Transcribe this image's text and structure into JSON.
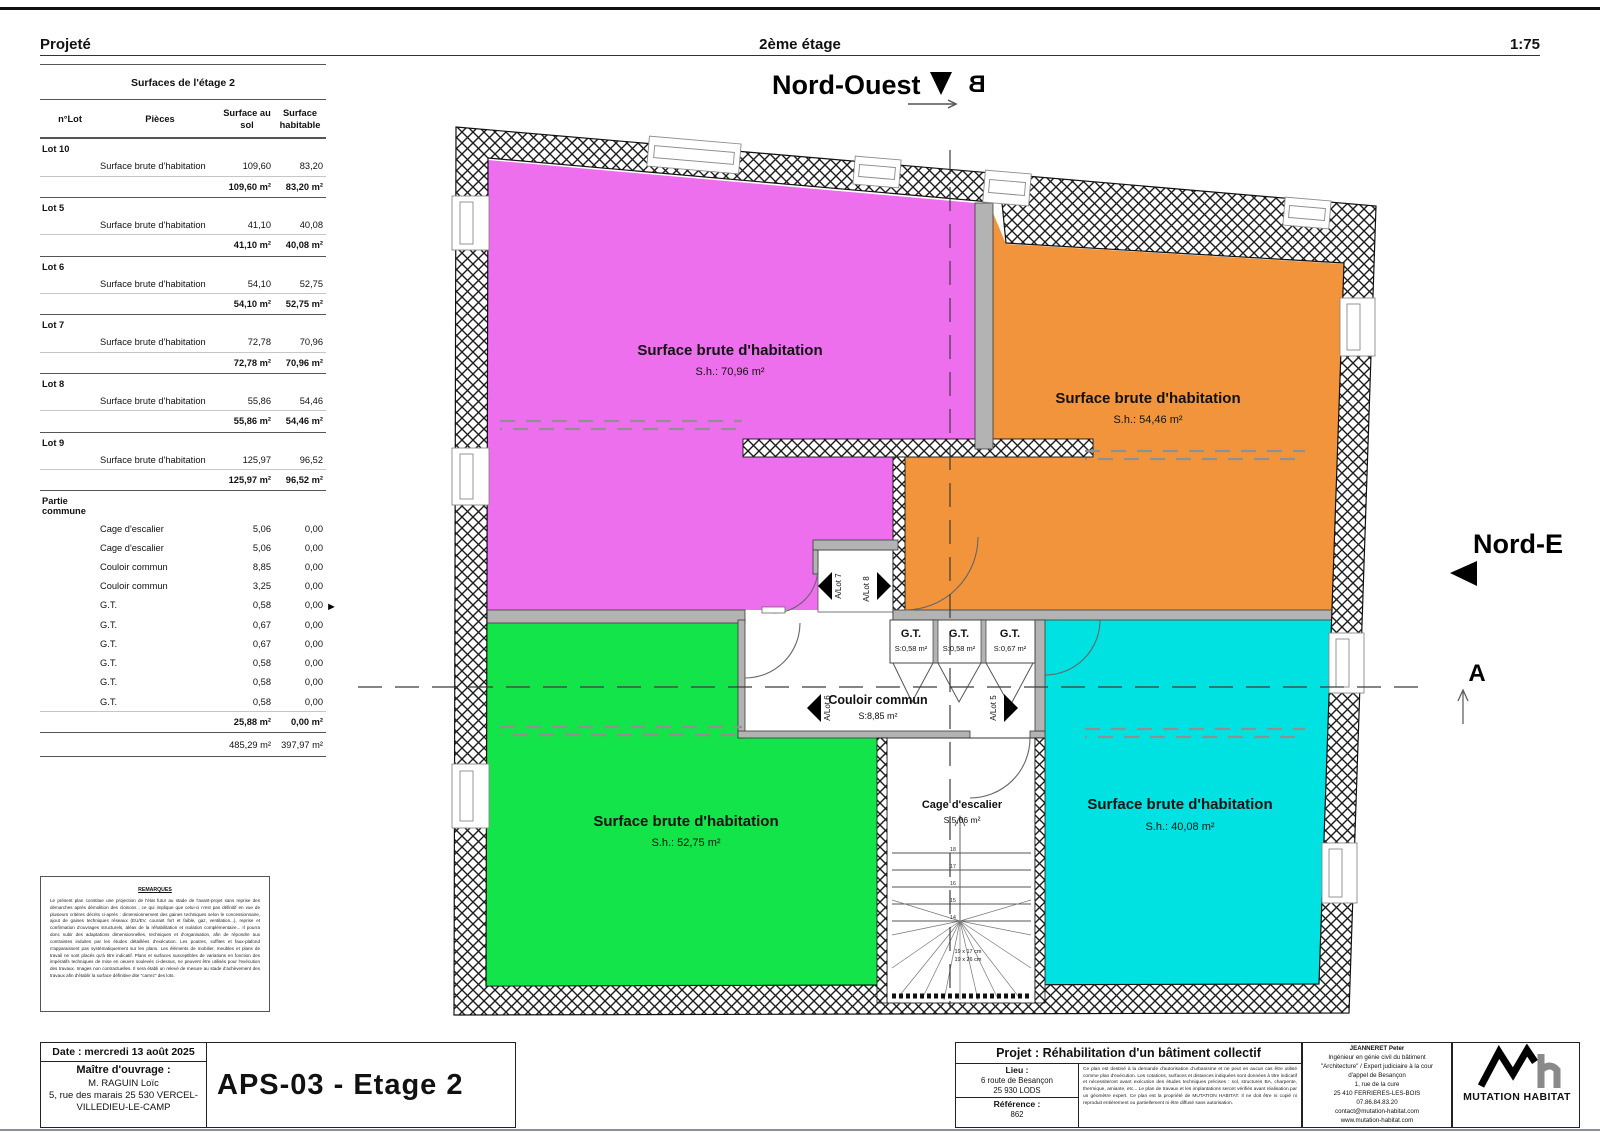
{
  "header": {
    "left": "Projeté",
    "center": "2ème étage",
    "right": "1:75"
  },
  "compass": {
    "nw": "Nord-Ouest",
    "ne": "Nord-E",
    "section_b": "B",
    "section_a": "A"
  },
  "table": {
    "title": "Surfaces de l'étage 2",
    "headers": {
      "lot": "n°Lot",
      "pieces": "Pièces",
      "sol": "Surface au sol",
      "hab": "Surface habitable"
    },
    "rows": [
      {
        "cls": "srow lot",
        "c1": "Lot 10"
      },
      {
        "cls": "srow detail",
        "c2": "Surface brute d'habitation",
        "c3": "109,60",
        "c4": "83,20"
      },
      {
        "cls": "srow total",
        "c3": "109,60 m²",
        "c4": "83,20 m²"
      },
      {
        "cls": "srow lot",
        "c1": "Lot 5"
      },
      {
        "cls": "srow detail",
        "c2": "Surface brute d'habitation",
        "c3": "41,10",
        "c4": "40,08"
      },
      {
        "cls": "srow total",
        "c3": "41,10 m²",
        "c4": "40,08 m²"
      },
      {
        "cls": "srow lot",
        "c1": "Lot 6"
      },
      {
        "cls": "srow detail",
        "c2": "Surface brute d'habitation",
        "c3": "54,10",
        "c4": "52,75"
      },
      {
        "cls": "srow total",
        "c3": "54,10 m²",
        "c4": "52,75 m²"
      },
      {
        "cls": "srow lot",
        "c1": "Lot 7"
      },
      {
        "cls": "srow detail",
        "c2": "Surface brute d'habitation",
        "c3": "72,78",
        "c4": "70,96"
      },
      {
        "cls": "srow total",
        "c3": "72,78 m²",
        "c4": "70,96 m²"
      },
      {
        "cls": "srow lot",
        "c1": "Lot 8"
      },
      {
        "cls": "srow detail",
        "c2": "Surface brute d'habitation",
        "c3": "55,86",
        "c4": "54,46"
      },
      {
        "cls": "srow total",
        "c3": "55,86 m²",
        "c4": "54,46 m²"
      },
      {
        "cls": "srow lot",
        "c1": "Lot 9"
      },
      {
        "cls": "srow detail",
        "c2": "Surface brute d'habitation",
        "c3": "125,97",
        "c4": "96,52"
      },
      {
        "cls": "srow total",
        "c3": "125,97 m²",
        "c4": "96,52 m²"
      },
      {
        "cls": "srow lot",
        "c1": "Partie commune"
      },
      {
        "cls": "srow detail",
        "c2": "Cage d'escalier",
        "c3": "5,06",
        "c4": "0,00"
      },
      {
        "cls": "srow detail",
        "c2": "Cage d'escalier",
        "c3": "5,06",
        "c4": "0,00"
      },
      {
        "cls": "srow detail",
        "c2": "Couloir commun",
        "c3": "8,85",
        "c4": "0,00"
      },
      {
        "cls": "srow detail",
        "c2": "Couloir commun",
        "c3": "3,25",
        "c4": "0,00"
      },
      {
        "cls": "srow detail",
        "c2": "G.T.",
        "c3": "0,58",
        "c4": "0,00"
      },
      {
        "cls": "srow detail",
        "c2": "G.T.",
        "c3": "0,67",
        "c4": "0,00"
      },
      {
        "cls": "srow detail",
        "c2": "G.T.",
        "c3": "0,67",
        "c4": "0,00"
      },
      {
        "cls": "srow detail",
        "c2": "G.T.",
        "c3": "0,58",
        "c4": "0,00"
      },
      {
        "cls": "srow detail",
        "c2": "G.T.",
        "c3": "0,58",
        "c4": "0,00"
      },
      {
        "cls": "srow detail",
        "c2": "G.T.",
        "c3": "0,58",
        "c4": "0,00"
      },
      {
        "cls": "srow total",
        "c3": "25,88 m²",
        "c4": "0,00 m²"
      },
      {
        "cls": "srow grand",
        "c3": "485,29 m²",
        "c4": "397,97 m²"
      }
    ]
  },
  "remarks": {
    "title": "REMARQUES",
    "body": "Le présent plan constitue une projection de l'état futur au stade de l'avant-projet sans reprise des démarches après démolition des cloisons ; ce qui implique que celui-ci n'est pas définitif en vue de plusieurs critères décrits ci-après : dimensionnement des gaines techniques selon le concessionnaire, ajout de gaines techniques réseaux (EU/EV, courant fort et faible, gaz, ventilation...), reprise et confirmation d'ouvrages structurels, aléas de la réhabilitation et isolation complémentaire... Il pourra donc subir des adaptations dimensionnelles, techniques et d'organisation, afin de répondre aux contraintes induites par les études détaillées d'exécution. Les poutres, soffites et faux-plafond n'apparaissent pas systématiquement sur les plans. Les éléments de mobilier, meubles et plans de travail ne sont placés qu'à titre indicatif. Plans et surfaces susceptibles de variations en fonction des impératifs techniques de mise en oeuvre soulevés ci-dessus, ne peuvent être utilisés pour l'exécution des travaux. Images non contractuelles. Il sera établi un relevé de mesure au stade d'achèvement des travaux afin d'établir la surface définitive dite \"carrez\" des lots."
  },
  "plan": {
    "rooms": [
      {
        "label": "Surface brute d'habitation",
        "area": "S.h.: 70,96 m²",
        "color": "#EE6FEE"
      },
      {
        "label": "Surface brute d'habitation",
        "area": "S.h.: 54,46 m²",
        "color": "#F2943B"
      },
      {
        "label": "Surface brute d'habitation",
        "area": "S.h.: 52,75 m²",
        "color": "#12E44A"
      },
      {
        "label": "Surface brute d'habitation",
        "area": "S.h.: 40,08 m²",
        "color": "#00E2E2"
      }
    ],
    "gt": [
      {
        "label": "G.T.",
        "area": "S:0,58 m²"
      },
      {
        "label": "G.T.",
        "area": "S:0,58 m²"
      },
      {
        "label": "G.T.",
        "area": "S:0,67 m²"
      }
    ],
    "couloir": {
      "label": "Couloir commun",
      "area": "S:8,85 m²"
    },
    "cage": {
      "label": "Cage d'escalier",
      "area": "S:5,06 m²"
    },
    "lot_doors": [
      "A/Lot 7",
      "A/Lot 8",
      "A/Lot 6",
      "A/Lot 5"
    ],
    "stair_steps": [
      "18",
      "17",
      "16",
      "15",
      "14"
    ],
    "stair_note1": "19 x 17 cm",
    "stair_note2": "19 x 26 cm"
  },
  "titleblock": {
    "date": "Date : mercredi 13 août 2025",
    "owner_label": "Maître d'ouvrage :",
    "owner_name": "M. RAGUIN Loïc",
    "owner_address": "5, rue des marais 25 530 VERCEL-VILLEDIEU-LE-CAMP",
    "sheet": "APS-03 - Etage 2",
    "project": "Projet : Réhabilitation d'un bâtiment collectif",
    "lieu_label": "Lieu :",
    "lieu1": "6 route de Besançon",
    "lieu2": "25 930 LODS",
    "ref_label": "Référence :",
    "ref": "862",
    "disclaimer": "Ce plan est destiné à la demande d'autorisation d'urbanisme et ne peut en aucun cas être utilisé comme plan d'exécution. Les cotations, surfaces et distances indiquées sont données à titre indicatif et nécessiteront avant exécution des études techniques précises : sol, structures BA, charpente, thermique, amiante, etc... Le plan de travaux et les implantations seront vérifiés avant réalisation par un géomètre expert. Ce plan est la propriété de MUTATION HABITAT. Il ne doit être ni copié ni reproduit entièrement ou partiellement ni être diffusé sans autorisation.",
    "engineer": {
      "name": "JEANNERET Peter",
      "l1": "Ingénieur en génie civil du bâtiment",
      "l2": "\"Architecture\" / Expert judiciaire à la cour",
      "l3": "d'appel de Besançon",
      "l4": "1, rue de la cure",
      "l5": "25 410 FERRIERES-LES-BOIS",
      "l6": "07.86.84.83.20",
      "l7": "contact@mutation-habitat.com",
      "l8": "www.mutation-habitat.com"
    },
    "logo_text": "MUTATION HABITAT"
  }
}
